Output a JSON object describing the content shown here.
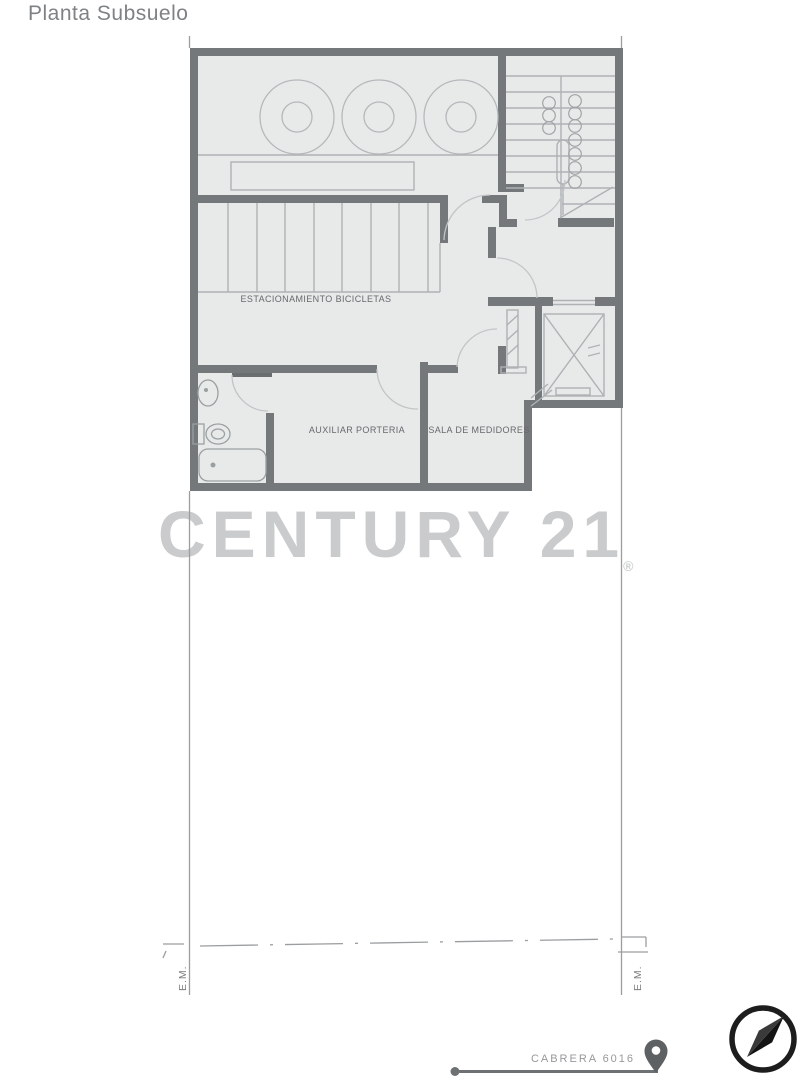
{
  "page": {
    "title": "Planta Subsuelo"
  },
  "watermark": {
    "brand": "CENTURY 21",
    "registered_mark": "®"
  },
  "floorplan": {
    "rooms": [
      {
        "id": "estacionamiento-bicicletas",
        "label": "ESTACIONAMIENTO BICICLETAS"
      },
      {
        "id": "auxiliar-porteria",
        "label": "AUXILIAR PORTERIA"
      },
      {
        "id": "sala-de-medidores",
        "label": "SALA DE MEDIDORES"
      }
    ],
    "boundary_marks": {
      "left": "E.M.",
      "right": "E.M."
    },
    "street_label": "CABRERA 6016",
    "symbols": [
      "staircase",
      "elevator",
      "bike-racks",
      "tanks",
      "bathroom-fixtures",
      "door-swings"
    ]
  },
  "icons": {
    "location_pin": "map-pin-icon",
    "compass": "compass-icon"
  },
  "colors": {
    "wall": "#74787b",
    "floor": "#e8eaea",
    "thin_line": "#aeb2b4",
    "door_arc": "#c2c5c7",
    "lot_line": "#9b9ea0",
    "room_label": "#66696c",
    "title": "#7f8285",
    "watermark": "#c9cbcc",
    "street_label": "#96989a",
    "pin": "#5d6164",
    "compass": "#1d1d1d"
  }
}
